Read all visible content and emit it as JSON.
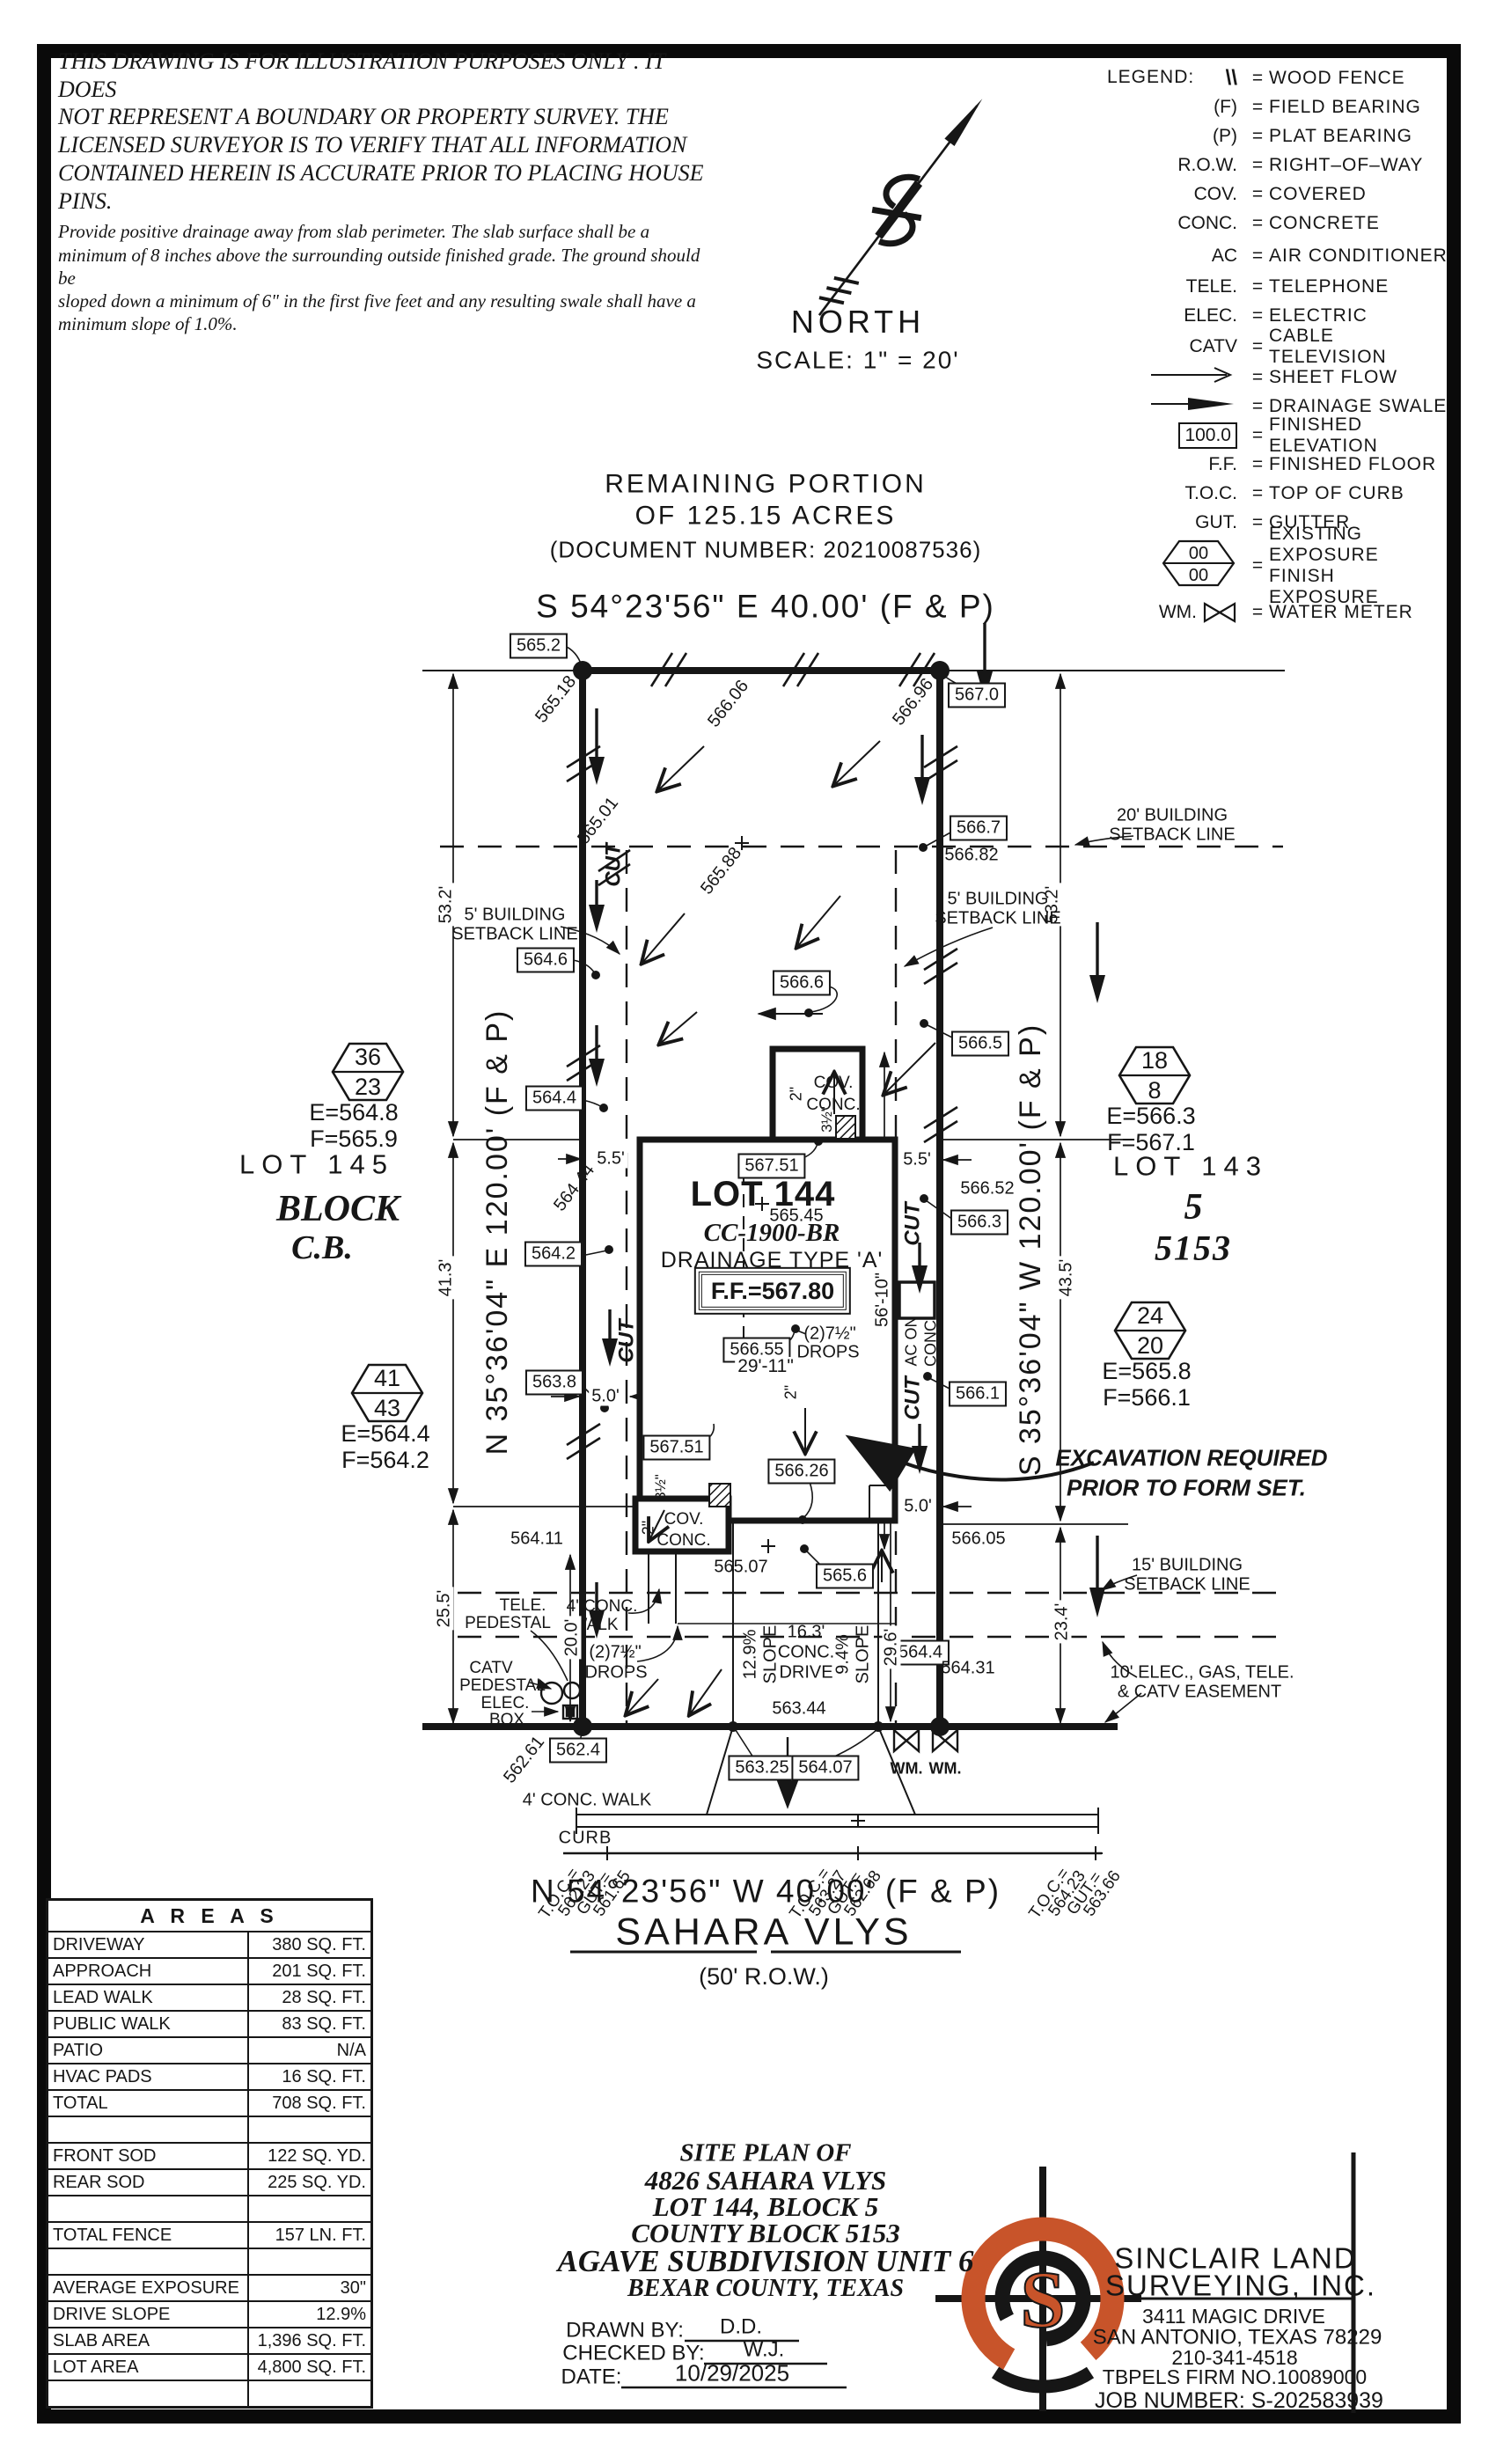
{
  "disclaimer": {
    "big": [
      "THIS DRAWING IS FOR ILLUSTRATION PURPOSES ONLY . IT DOES",
      "NOT REPRESENT A BOUNDARY OR PROPERTY SURVEY. THE",
      "LICENSED SURVEYOR IS TO VERIFY THAT ALL INFORMATION",
      "CONTAINED HEREIN IS ACCURATE PRIOR TO PLACING HOUSE PINS."
    ],
    "small": [
      "Provide positive drainage away from slab perimeter. The slab surface shall be a",
      "minimum of 8 inches above the surrounding outside finished grade. The ground should be",
      "sloped down a minimum of 6\" in the first five feet and any resulting swale shall have a",
      "minimum slope of 1.0%."
    ]
  },
  "legend": {
    "title": "LEGEND:",
    "eq": "=",
    "rows": [
      {
        "sym": "\\\\",
        "desc": "WOOD FENCE"
      },
      {
        "sym": "(F)",
        "desc": "FIELD BEARING"
      },
      {
        "sym": "(P)",
        "desc": "PLAT BEARING"
      },
      {
        "sym": "R.O.W.",
        "desc": "RIGHT–OF–WAY"
      },
      {
        "sym": "COV.",
        "desc": "COVERED"
      },
      {
        "sym": "CONC.",
        "desc": "CONCRETE"
      },
      {
        "sym": "AC",
        "desc": "AIR CONDITIONER"
      },
      {
        "sym": "TELE.",
        "desc": "TELEPHONE"
      },
      {
        "sym": "ELEC.",
        "desc": "ELECTRIC"
      },
      {
        "sym": "CATV",
        "desc": "CABLE TELEVISION"
      },
      {
        "sym": "",
        "desc": "SHEET FLOW"
      },
      {
        "sym": "",
        "desc": "DRAINAGE SWALE"
      },
      {
        "sym": "100.0",
        "desc": "FINISHED ELEVATION"
      },
      {
        "sym": "F.F.",
        "desc": "FINISHED FLOOR"
      },
      {
        "sym": "T.O.C.",
        "desc": "TOP OF CURB"
      },
      {
        "sym": "GUT.",
        "desc": "GUTTER"
      },
      {
        "sym": "00",
        "sym2": "00",
        "desc": "EXISTING EXPOSURE",
        "desc2": "FINISH EXPOSURE"
      },
      {
        "sym": "WM.",
        "desc": "WATER METER"
      }
    ]
  },
  "north": {
    "label": "NORTH",
    "scale": "SCALE:  1\" = 20'"
  },
  "header": {
    "l1": "REMAINING PORTION",
    "l2": "OF 125.15 ACRES",
    "l3": "(DOCUMENT NUMBER:  20210087536)"
  },
  "bearings": {
    "top": "S 54°23'56\" E 40.00' (F & P)",
    "bottom": "N 54°23'56\" W 40.00' (F & P)",
    "left": "N 35°36'04\" E 120.00' (F & P)",
    "right": "S 35°36'04\" W 120.00' (F & P)"
  },
  "street": {
    "name": "SAHARA VLYS",
    "row_label": "(50' R.O.W.)",
    "curb": "CURB",
    "public_walk": "4' CONC. WALK"
  },
  "toc": [
    {
      "toc_label": "T.O.C.=",
      "toc": "562.23",
      "gut_label": "GUT.=",
      "gut": "561.65"
    },
    {
      "toc_label": "T.O.C.=",
      "toc": "563.27",
      "gut_label": "GUT.=",
      "gut": "562.68"
    },
    {
      "toc_label": "T.O.C.=",
      "toc": "564.23",
      "gut_label": "GUT.=",
      "gut": "563.66"
    }
  ],
  "house": {
    "name": "LOT  144",
    "spot": "565.45",
    "model": "CC-1900-BR",
    "drainage": "DRAINAGE TYPE 'A'",
    "ff": "F.F.=567.80"
  },
  "neighbors": {
    "left_lot": "LOT 145",
    "left_block": "BLOCK",
    "left_cb": "C.B.",
    "right_lot": "LOT 143",
    "right_block": "5",
    "right_cb": "5153"
  },
  "hexes": [
    {
      "t": "36",
      "b": "23",
      "e": "E=564.8",
      "f": "F=565.9"
    },
    {
      "t": "41",
      "b": "43",
      "e": "E=564.4",
      "f": "F=564.2"
    },
    {
      "t": "18",
      "b": "8",
      "e": "E=566.3",
      "f": "F=567.1"
    },
    {
      "t": "24",
      "b": "20",
      "e": "E=565.8",
      "f": "F=566.1"
    }
  ],
  "setbacks": {
    "s20a": "20' BUILDING",
    "s20b": "SETBACK LINE",
    "s5a": "5' BUILDING",
    "s5b": "SETBACK LINE",
    "s15a": "15' BUILDING",
    "s15b": "SETBACK LINE",
    "e10a": "10' ELEC., GAS, TELE.",
    "e10b": "& CATV EASEMENT"
  },
  "excavation": {
    "l1": "EXCAVATION REQUIRED",
    "l2": "PRIOR TO FORM SET."
  },
  "dims": {
    "d53": "53.2'",
    "d41": "41.3'",
    "d43": "43.5'",
    "d25": "25.5'",
    "d23": "23.4'",
    "d20": "20.0'",
    "d29_6": "29.6'",
    "d29_11": "29'-11\"",
    "d56_10": "56'-10\"",
    "d5_5": "5.5'",
    "d5_0": "5.0'"
  },
  "features": {
    "cov1": "COV.",
    "cov2": "CONC.",
    "ac1": "AC ON",
    "ac2": "CONC.",
    "cut": "CUT",
    "drops1": "(2)7½\"",
    "drops2": "DROPS",
    "walk_l1": "4' CONC.",
    "walk_l2": "WALK",
    "two_in": "2\"",
    "three_half": "3½\"",
    "tele1": "TELE.",
    "tele2": "PEDESTAL",
    "catv1": "CATV",
    "catv2": "PEDESTAL",
    "elec1": "ELEC.",
    "elec2": "BOX",
    "wm": "WM.",
    "drive1": "16.3'",
    "drive2": "CONC.",
    "drive3": "DRIVE",
    "slope_l": "12.9%",
    "slope_r": "9.4%",
    "slope_word": "SLOPE"
  },
  "spots": {
    "s565_18": "565.18",
    "s565_01": "565.01",
    "s566_06": "566.06",
    "s566_96": "566.96",
    "s565_88": "565.88",
    "s566_82": "566.82",
    "s566_52": "566.52",
    "s564_44": "564.44",
    "s564_11": "564.11",
    "s565_07": "565.07",
    "s566_05": "566.05",
    "s564_31": "564.31",
    "s562_61": "562.61",
    "s563_44": "563.44"
  },
  "boxes": {
    "b565_2": "565.2",
    "b567_0": "567.0",
    "b566_7": "566.7",
    "b564_6": "564.6",
    "b566_6": "566.6",
    "b566_5": "566.5",
    "b564_4l": "564.4",
    "b564_2": "564.2",
    "b563_8": "563.8",
    "b567_51a": "567.51",
    "b566_55": "566.55",
    "b566_3": "566.3",
    "b566_26": "566.26",
    "b567_51b": "567.51",
    "b566_1": "566.1",
    "b565_6": "565.6",
    "b564_4r": "564.4",
    "b562_4": "562.4",
    "b563_25": "563.25",
    "b564_07": "564.07"
  },
  "areas": {
    "title": "A R E A S",
    "rows": [
      {
        "label": "DRIVEWAY",
        "value": "380 SQ. FT."
      },
      {
        "label": "APPROACH",
        "value": "201 SQ. FT."
      },
      {
        "label": "LEAD WALK",
        "value": "28 SQ. FT."
      },
      {
        "label": "PUBLIC WALK",
        "value": "83 SQ. FT."
      },
      {
        "label": "PATIO",
        "value": "N/A"
      },
      {
        "label": "HVAC PADS",
        "value": "16 SQ. FT."
      },
      {
        "label": "TOTAL",
        "value": "708 SQ. FT."
      },
      {
        "label": "",
        "value": ""
      },
      {
        "label": "FRONT SOD",
        "value": "122 SQ. YD."
      },
      {
        "label": "REAR SOD",
        "value": "225 SQ. YD."
      },
      {
        "label": "",
        "value": ""
      },
      {
        "label": "TOTAL FENCE",
        "value": "157 LN. FT."
      },
      {
        "label": "",
        "value": ""
      },
      {
        "label": "AVERAGE EXPOSURE",
        "value": "30\""
      },
      {
        "label": "DRIVE SLOPE",
        "value": "12.9%"
      },
      {
        "label": "SLAB AREA",
        "value": "1,396 SQ. FT."
      },
      {
        "label": "LOT AREA",
        "value": "4,800 SQ. FT."
      },
      {
        "label": "",
        "value": ""
      }
    ]
  },
  "title_block": {
    "l1": "SITE PLAN OF",
    "l2": "4826 SAHARA VLYS",
    "l3": "LOT 144, BLOCK 5",
    "l4": "COUNTY BLOCK 5153",
    "l5": "AGAVE SUBDIVISION UNIT 6",
    "l6": "BEXAR COUNTY, TEXAS",
    "drawn_label": "DRAWN BY:",
    "drawn": "D.D.",
    "checked_label": "CHECKED BY:",
    "checked": "W.J.",
    "date_label": "DATE:",
    "date": "10/29/2025"
  },
  "firm": {
    "logo_letter": "S",
    "name1": "SINCLAIR LAND",
    "name2": "SURVEYING, INC.",
    "addr1": "3411 MAGIC DRIVE",
    "addr2": "SAN ANTONIO, TEXAS 78229",
    "phone": "210-341-4518",
    "tbpels": "TBPELS FIRM NO.10089000",
    "job": "JOB NUMBER:  S-202583939"
  },
  "colors": {
    "ink": "#161616",
    "accent": "#c8542a"
  }
}
